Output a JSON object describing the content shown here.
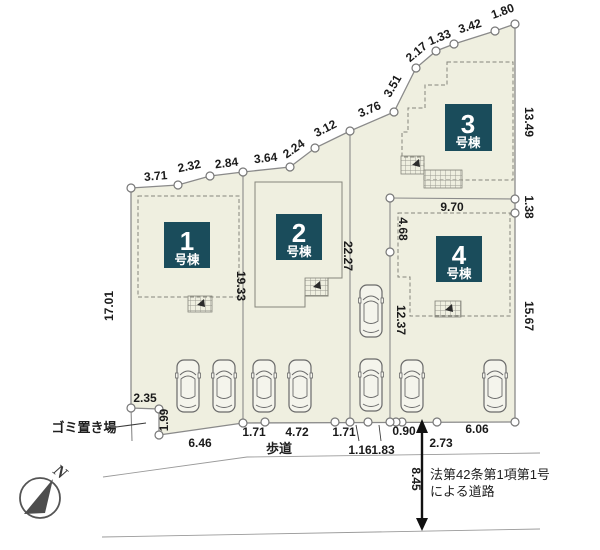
{
  "plan": {
    "buildings": [
      {
        "num": "1",
        "suffix": "号棟"
      },
      {
        "num": "2",
        "suffix": "号棟"
      },
      {
        "num": "3",
        "suffix": "号棟"
      },
      {
        "num": "4",
        "suffix": "号棟"
      }
    ],
    "dims": {
      "top": [
        "3.71",
        "2.32",
        "2.84",
        "3.64",
        "2.24",
        "3.12",
        "3.76",
        "3.51",
        "2.17",
        "1.33",
        "3.42",
        "1.80"
      ],
      "left": "17.01",
      "lot1_right": "19.33",
      "lot2_right": "22.27",
      "right_upper": "13.49",
      "right_mid": "1.38",
      "right_lower": "15.67",
      "lot4_top": "9.70",
      "lot4_left_upper": "4.68",
      "lot4_left_lower": "12.37",
      "trash_w": "2.35",
      "trash_h": "1.99",
      "bottom": [
        "6.46",
        "1.71",
        "4.72",
        "1.71",
        "1.16",
        "1.83",
        "0.90",
        "2.73",
        "6.06"
      ],
      "road_width": "8.45"
    },
    "labels": {
      "trash": "ゴミ置き場",
      "sidewalk": "歩道",
      "road_note1": "法第42条第1項第1号",
      "road_note2": "による道路",
      "north": "N"
    },
    "colors": {
      "parcel_fill": "#efefe0",
      "boundary_line": "#8a8a8a",
      "building_label_bg": "#1a4c5b",
      "arrow_black": "#111111"
    }
  }
}
